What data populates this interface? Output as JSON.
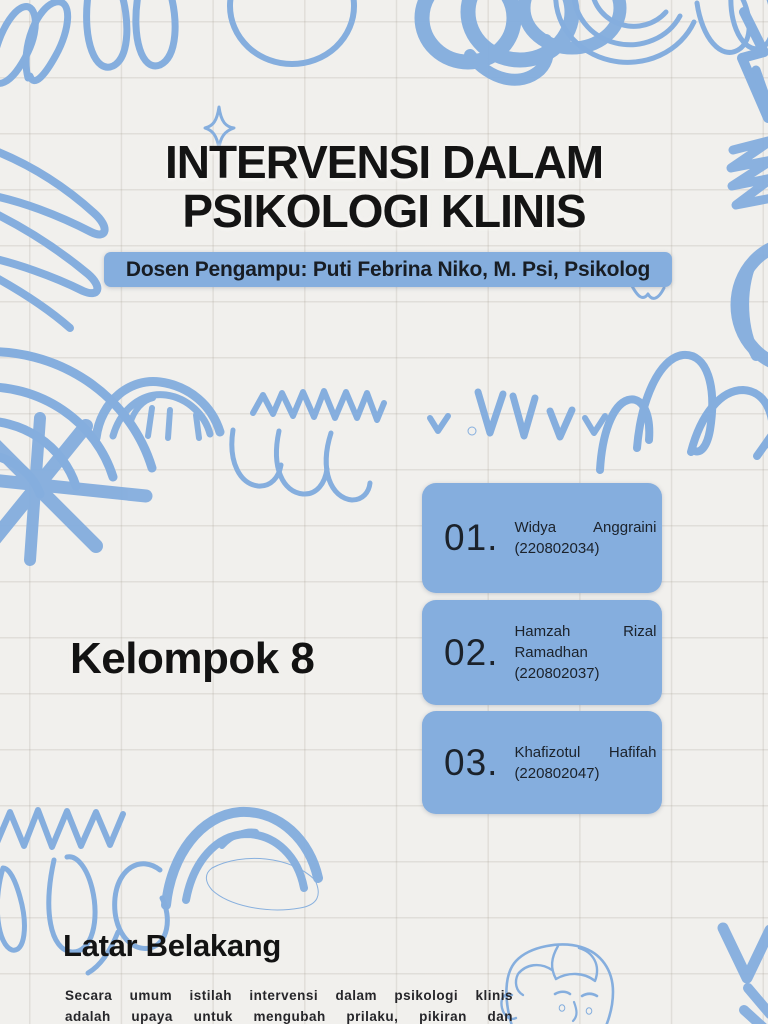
{
  "slide": {
    "title_line1": "INTERVENSI DALAM",
    "title_line2": "PSIKOLOGI KLINIS",
    "subtitle": "Dosen Pengampu: Puti Febrina Niko, M. Psi, Psikolog",
    "group_label": "Kelompok 8",
    "members": [
      {
        "number": "01.",
        "name": "Widya Anggraini",
        "id": "(220802034)"
      },
      {
        "number": "02.",
        "name": "Hamzah Rizal Ramadhan",
        "id": "(220802037)"
      },
      {
        "number": "03.",
        "name": "Khafizotul Hafifah",
        "id": "(220802047)"
      }
    ],
    "section_heading": "Latar Belakang",
    "section_paragraph_line1": "Secara umum istilah intervensi dalam psikologi klinis",
    "section_paragraph_line2": "adalah upaya untuk mengubah prilaku, pikiran dan"
  },
  "colors": {
    "accent_blue": "#85aede",
    "paper_background": "#f1f0ed",
    "text_dark": "#141414",
    "card_text": "#1b222b"
  },
  "decorations": [
    "loop-scribbles",
    "spiral-blob",
    "concentric-rings",
    "sparkle",
    "squiggle",
    "rainbow-arcs",
    "asterisk-scribble",
    "crayon-arch",
    "zigzag-line",
    "swoosh-curves",
    "checkmarks",
    "double-arch",
    "circle-scribble",
    "dense-zigzag",
    "bird-mark",
    "filled-arch",
    "face-sketch"
  ]
}
